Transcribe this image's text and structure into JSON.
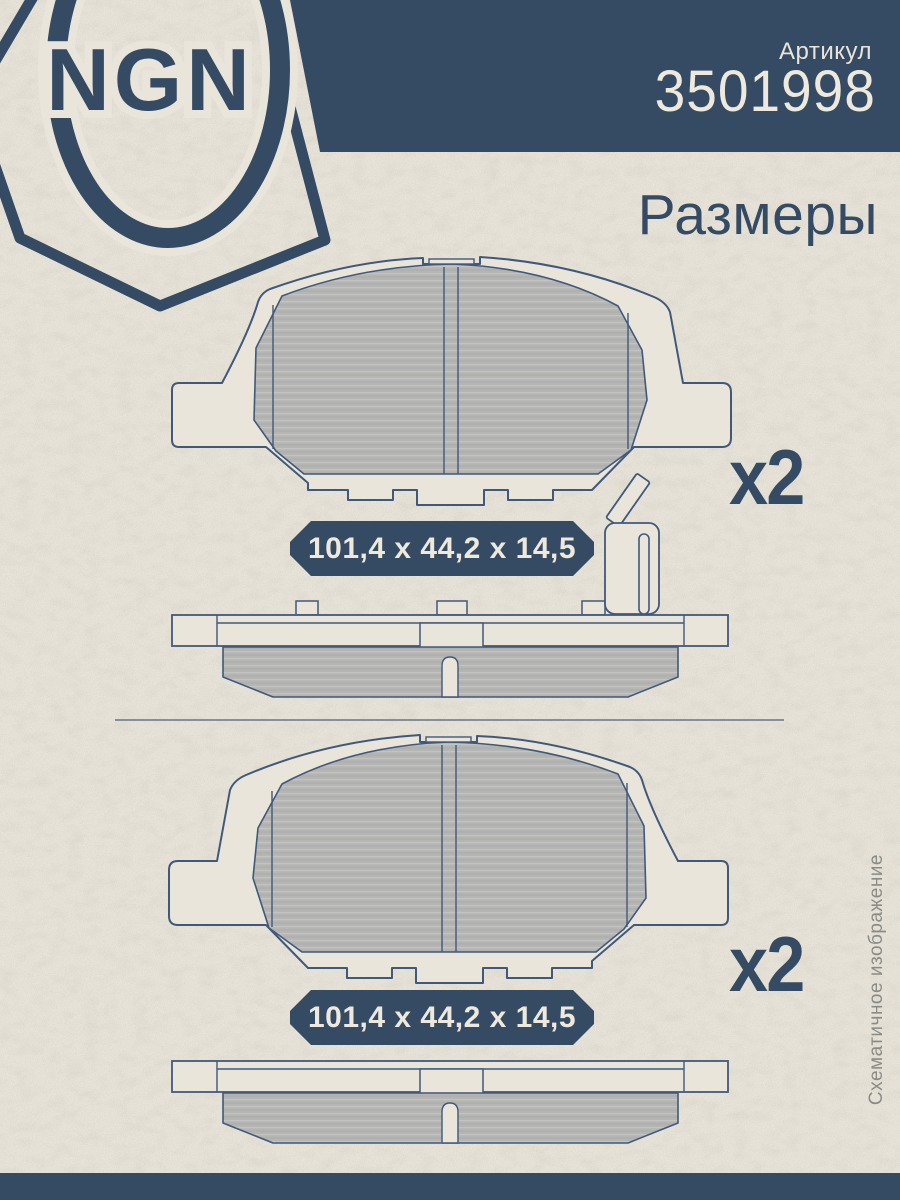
{
  "brand": {
    "logo_text": "NGN"
  },
  "header": {
    "article_label": "Артикул",
    "article_number": "3501998",
    "section_title": "Размеры"
  },
  "items": [
    {
      "dimensions": "101,4 x 44,2 x 14,5",
      "quantity": "x2"
    },
    {
      "dimensions": "101,4 x 44,2 x 14,5",
      "quantity": "x2"
    }
  ],
  "note": {
    "vertical_text": "Схематичное изображение"
  },
  "colors": {
    "accent_blue": "#344b63",
    "paper": "#e9e5db",
    "pad_gray": "#b5b5b4",
    "outline_blue": "#40597a",
    "text_cream": "#eee9dc",
    "note_gray": "#8b8b85"
  }
}
